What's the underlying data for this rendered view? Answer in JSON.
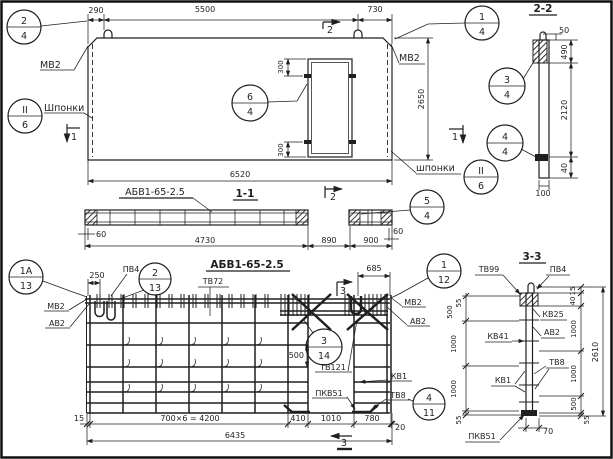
{
  "colors": {
    "ink": "#1f1f1f",
    "paper": "#ffffff"
  },
  "top_view": {
    "dim_290": "290",
    "dim_5500": "5500",
    "dim_730": "730",
    "dim_6520": "6520",
    "dim_2650": "2650",
    "dim_300_top": "300",
    "dim_300_bottom": "300",
    "label_mv2_left": "МВ2",
    "label_mv2_right": "МВ2",
    "label_shponki_left": "Шпонки",
    "label_shponki_right": "шпонки",
    "flag_1_left": "1",
    "flag_1_right": "1",
    "flag_2_top": "2",
    "flag_2_bottom": "2"
  },
  "section_1_1": {
    "title": "1-1",
    "mark": "АБВ1-65-2.5",
    "dim_60_left": "60",
    "dim_4730": "4730",
    "dim_890": "890",
    "dim_900": "900",
    "dim_60_right": "60"
  },
  "section_2_2": {
    "title": "2-2",
    "dim_50": "50",
    "dim_490": "490",
    "dim_2120": "2120",
    "dim_40": "40",
    "dim_100": "100"
  },
  "plan": {
    "title": "АБВ1-65-2.5",
    "dim_250": "250",
    "dim_685": "685",
    "dim_500": "500",
    "dim_15": "15",
    "dim_700x6": "700×6 = 4200",
    "dim_410": "410",
    "dim_1010": "1010",
    "dim_780": "780",
    "dim_20": "20",
    "dim_6435": "6435",
    "label_pv4": "ПВ4",
    "label_tv72": "ТВ72",
    "label_mv2_left": "МВ2",
    "label_av2_left": "АВ2",
    "label_mv2_right": "МВ2",
    "label_av2_right": "АВ2",
    "label_tv121": "ТВ121",
    "label_kv1": "КВ1",
    "label_pkv51": "ПКВ51",
    "label_tv8": "ТВ8",
    "flag_3_top": "3",
    "flag_3_bottom": "3"
  },
  "section_3_3": {
    "title": "3-3",
    "label_tv99": "ТВ99",
    "label_pv4": "ПВ4",
    "label_kv25": "КВ25",
    "label_av2": "АВ2",
    "label_kv41": "КВ41",
    "label_tv8": "ТВ8",
    "label_kv1": "КВ1",
    "label_pkv51": "ПКВ51",
    "left_dims": [
      "55",
      "500",
      "1000",
      "1000",
      "55"
    ],
    "right_dims": [
      "15",
      "40",
      "1000",
      "1000",
      "500",
      "55"
    ],
    "dim_2610": "2610",
    "dim_70": "70"
  },
  "balloons": {
    "b2_4": {
      "top": "2",
      "bottom": "4"
    },
    "bII_6_left": {
      "top": "II",
      "bottom": "6"
    },
    "b1_4": {
      "top": "1",
      "bottom": "4"
    },
    "b3_4": {
      "top": "3",
      "bottom": "4"
    },
    "b4_4": {
      "top": "4",
      "bottom": "4"
    },
    "bII_6_right": {
      "top": "II",
      "bottom": "6"
    },
    "b5_4": {
      "top": "5",
      "bottom": "4"
    },
    "b6_4": {
      "top": "6",
      "bottom": "4"
    },
    "b1a_13": {
      "top": "1А",
      "bottom": "13"
    },
    "b2_13": {
      "top": "2",
      "bottom": "13"
    },
    "b1_12": {
      "top": "1",
      "bottom": "12"
    },
    "b3_14": {
      "top": "3",
      "bottom": "14"
    },
    "b4_11": {
      "top": "4",
      "bottom": "11"
    }
  }
}
